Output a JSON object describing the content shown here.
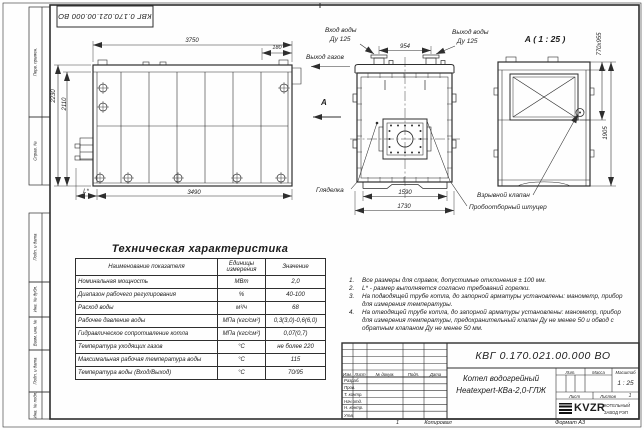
{
  "doc": {
    "number": "КВГ 0.170.021.00.000 ВО"
  },
  "frame": {
    "left_fields": [
      "Перв. примен.",
      "Справ. №",
      "Подп. и дата",
      "Инв. № дубл.",
      "Взам. инв. №",
      "Подп. и дата",
      "Инв. № подл."
    ],
    "copied": "Копировал",
    "format": "Формат А3",
    "sheet_mark": "1"
  },
  "side_view": {
    "dim_top": "3750",
    "dim_top_right": "180",
    "dim_left_outer": "2230",
    "dim_left_inner": "2110",
    "dim_bottom": "3490",
    "dim_bottom_left": "L*"
  },
  "front_view": {
    "water_in_1": "Вход воды",
    "water_in_2": "Ду 125",
    "water_out_1": "Выход воды",
    "water_out_2": "Ду 125",
    "gas_out": "Выход газов",
    "view_arrow": "А",
    "dim_flanges": "954",
    "dim_bottom_inner": "1590",
    "dim_bottom_outer": "1730",
    "sight_glass": "Гляделка",
    "explosion_valve": "Взрывной клапан",
    "sampling_fitting": "Пробоотборный штуцер"
  },
  "detail_view": {
    "title": "А ( 1 : 25 )",
    "dim_opening": "770х955",
    "dim_height": "1905"
  },
  "spec_table": {
    "title": "Техническая характеристика",
    "headers": [
      "Наименование показателя",
      "Единицы измерения",
      "Значение"
    ],
    "rows": [
      [
        "Номинальная мощность",
        "МВт",
        "2,0"
      ],
      [
        "Диапазон рабочего регулирования",
        "%",
        "40-100"
      ],
      [
        "Расход воды",
        "м³/ч",
        "68"
      ],
      [
        "Рабочее давление воды",
        "МПа (кгс/см²)",
        "0,3(3,0)-0,6(6,0)"
      ],
      [
        "Гидравлическое сопротивление котла",
        "МПа (кгс/см²)",
        "0,07(0,7)"
      ],
      [
        "Температура уходящих газов",
        "°С",
        "не более 220"
      ],
      [
        "Максимальная рабочая температура воды",
        "°С",
        "115"
      ],
      [
        "Температура воды (Вход/Выход)",
        "°С",
        "70/95"
      ]
    ]
  },
  "notes": [
    "Все размеры для справок, допустимые отклонения ± 100 мм.",
    "L* - размер выполняется согласно требований горелки.",
    "На подводящей трубе котла, до запорной арматуры установлены: манометр, прибор для измерения температуры.",
    "На отводящей трубе котла, до запорной арматуры установлены: манометр, прибор для измерения температуры, предохранительный клапан Ду не менее 50 и обвод с обратным клапаном Ду не менее 50 мм."
  ],
  "title_block": {
    "doc_number": "КВГ 0.170.021.00.000 ВО",
    "product_line1": "Котел водогрейный",
    "product_line2": "Heatexpert-КВа-2,0-ГЛЖ",
    "rev_headers": [
      "Изм.",
      "Лист",
      "№ докум.",
      "Подп.",
      "Дата"
    ],
    "sign_rows": [
      "Разраб.",
      "Пров.",
      "Т. контр.",
      "Нач.отд.",
      "Н. контр.",
      "Утв."
    ],
    "lit": "Лит.",
    "mass": "Масса",
    "scale": "Масштаб",
    "scale_value": "1 : 25",
    "sheet": "Лист",
    "sheets": "Листов",
    "sheets_value": "1",
    "logo_text": "KVZR",
    "company_line1": "КОТЕЛЬНЫЙ",
    "company_line2": "ЗАВОД РЭП"
  }
}
